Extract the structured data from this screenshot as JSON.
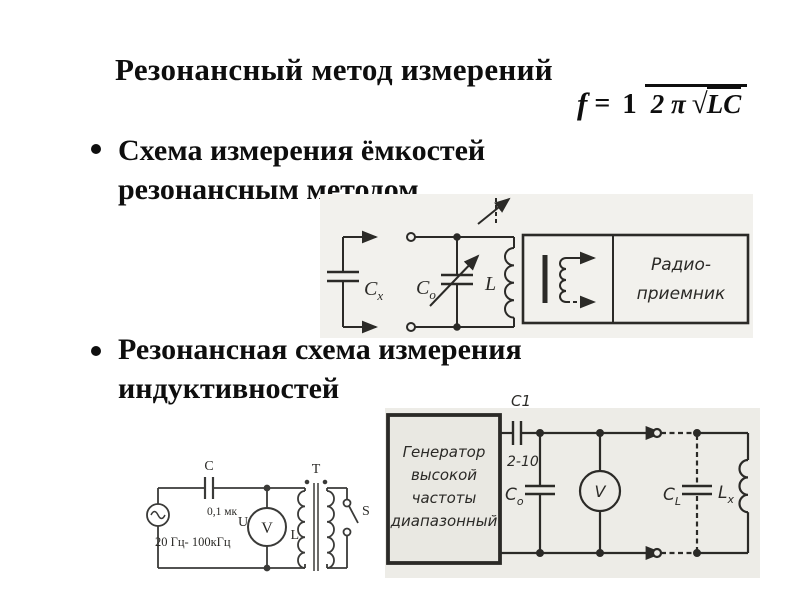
{
  "colors": {
    "background": "#ffffff",
    "text_ink": "#0e0e0e",
    "diagram_ink": "#2b2a27",
    "diagram1_bg": "#f2f1ed",
    "diagram3_bg": "#edece7"
  },
  "slide": {
    "title": "Резонансный метод измерений",
    "bullet1": {
      "line1": "Схема измерения ёмкостей",
      "line2": "резонансным методом"
    },
    "bullet2": {
      "line1": "Резонансная схема измерения",
      "line2": "индуктивностей"
    },
    "formula": {
      "lhs": "f",
      "equals": "=",
      "numerator": "1",
      "denominator_coeff": "2 π",
      "radical_sign": "√",
      "radicand": "LC"
    }
  },
  "capacitance_diagram": {
    "unknown_cap_base": "C",
    "unknown_cap_sub": "x",
    "tuning_cap_base": "C",
    "tuning_cap_sub": "o",
    "inductor": "L",
    "receiver_line1": "Радио-",
    "receiver_line2": "приемник"
  },
  "inductance_left": {
    "cap": "C",
    "cap_value": "0,1 мк",
    "source": "U",
    "freq_range": "20 Гц- 100кГц",
    "voltmeter": "V",
    "inductor": "L",
    "transformer": "T",
    "switch": "S"
  },
  "inductance_right": {
    "generator_line1": "Генератор",
    "generator_line2": "высокой",
    "generator_line3": "частоты",
    "generator_line4": "диапазонный",
    "coupling_cap": "C1",
    "coupling_cap_value": "2-10",
    "tuning_cap_base": "C",
    "tuning_cap_sub": "o",
    "voltmeter": "V",
    "equiv_cap_base": "C",
    "equiv_cap_sub": "L",
    "unknown_ind_base": "L",
    "unknown_ind_sub": "x"
  }
}
